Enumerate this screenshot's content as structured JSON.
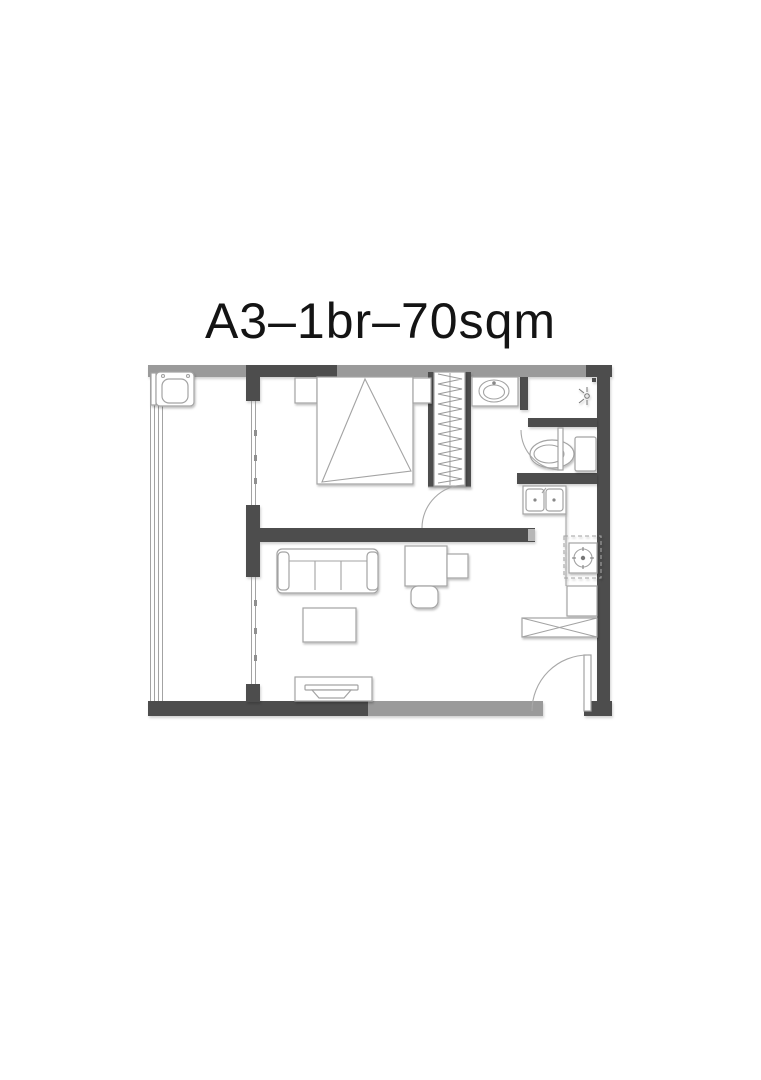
{
  "header": {
    "title": "A3–1br–70sqm"
  },
  "floorplan": {
    "unit_code": "A3",
    "bedroom_count": "1br",
    "area": "70sqm",
    "colors": {
      "background": "#ffffff",
      "title": "#141414",
      "wall_light": "#9a9a9a",
      "wall_dark": "#4d4d4d",
      "furniture_line": "#a3a3a3",
      "furniture_fill": "#ffffff"
    },
    "furniture_icons": [
      "washing-machine",
      "bed",
      "nightstand",
      "wardrobe",
      "vanity-basin",
      "shower-head",
      "toilet",
      "kitchen-sink",
      "cooktop",
      "kitchen-cabinet",
      "shoe-cabinet",
      "sofa",
      "coffee-table",
      "desk",
      "desk-chair",
      "side-table",
      "tv-console"
    ],
    "door_icons": [
      "bedroom-door-arc",
      "wc-door-arc",
      "entry-door-arc",
      "balcony-sliding-door-bedroom",
      "balcony-sliding-door-living",
      "balcony-window"
    ]
  }
}
